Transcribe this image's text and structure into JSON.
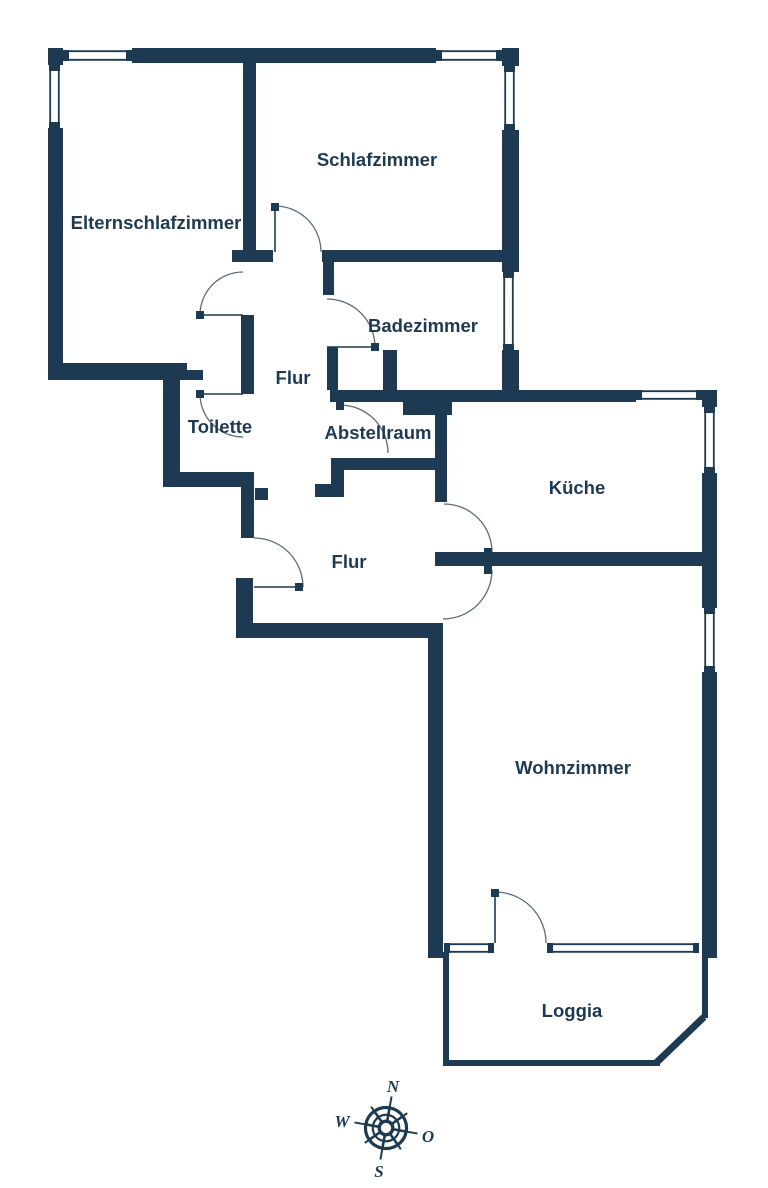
{
  "plan": {
    "type": "apartment-floor-plan",
    "colors": {
      "wall": "#1e3a53",
      "background": "#ffffff",
      "door_arc": "#5b6b7c",
      "label": "#1e3a53"
    },
    "rooms": [
      {
        "id": "elternschlafzimmer",
        "label": "Elternschlafzimmer"
      },
      {
        "id": "schlafzimmer",
        "label": "Schlafzimmer"
      },
      {
        "id": "badezimmer",
        "label": "Badezimmer"
      },
      {
        "id": "flur-oben",
        "label": "Flur"
      },
      {
        "id": "toilette",
        "label": "Toilette"
      },
      {
        "id": "abstellraum",
        "label": "Abstellraum"
      },
      {
        "id": "kueche",
        "label": "Küche"
      },
      {
        "id": "flur-unten",
        "label": "Flur"
      },
      {
        "id": "wohnzimmer",
        "label": "Wohnzimmer"
      },
      {
        "id": "loggia",
        "label": "Loggia"
      }
    ],
    "compass": {
      "labels": {
        "north": "N",
        "east": "O",
        "south": "S",
        "west": "W"
      }
    }
  }
}
